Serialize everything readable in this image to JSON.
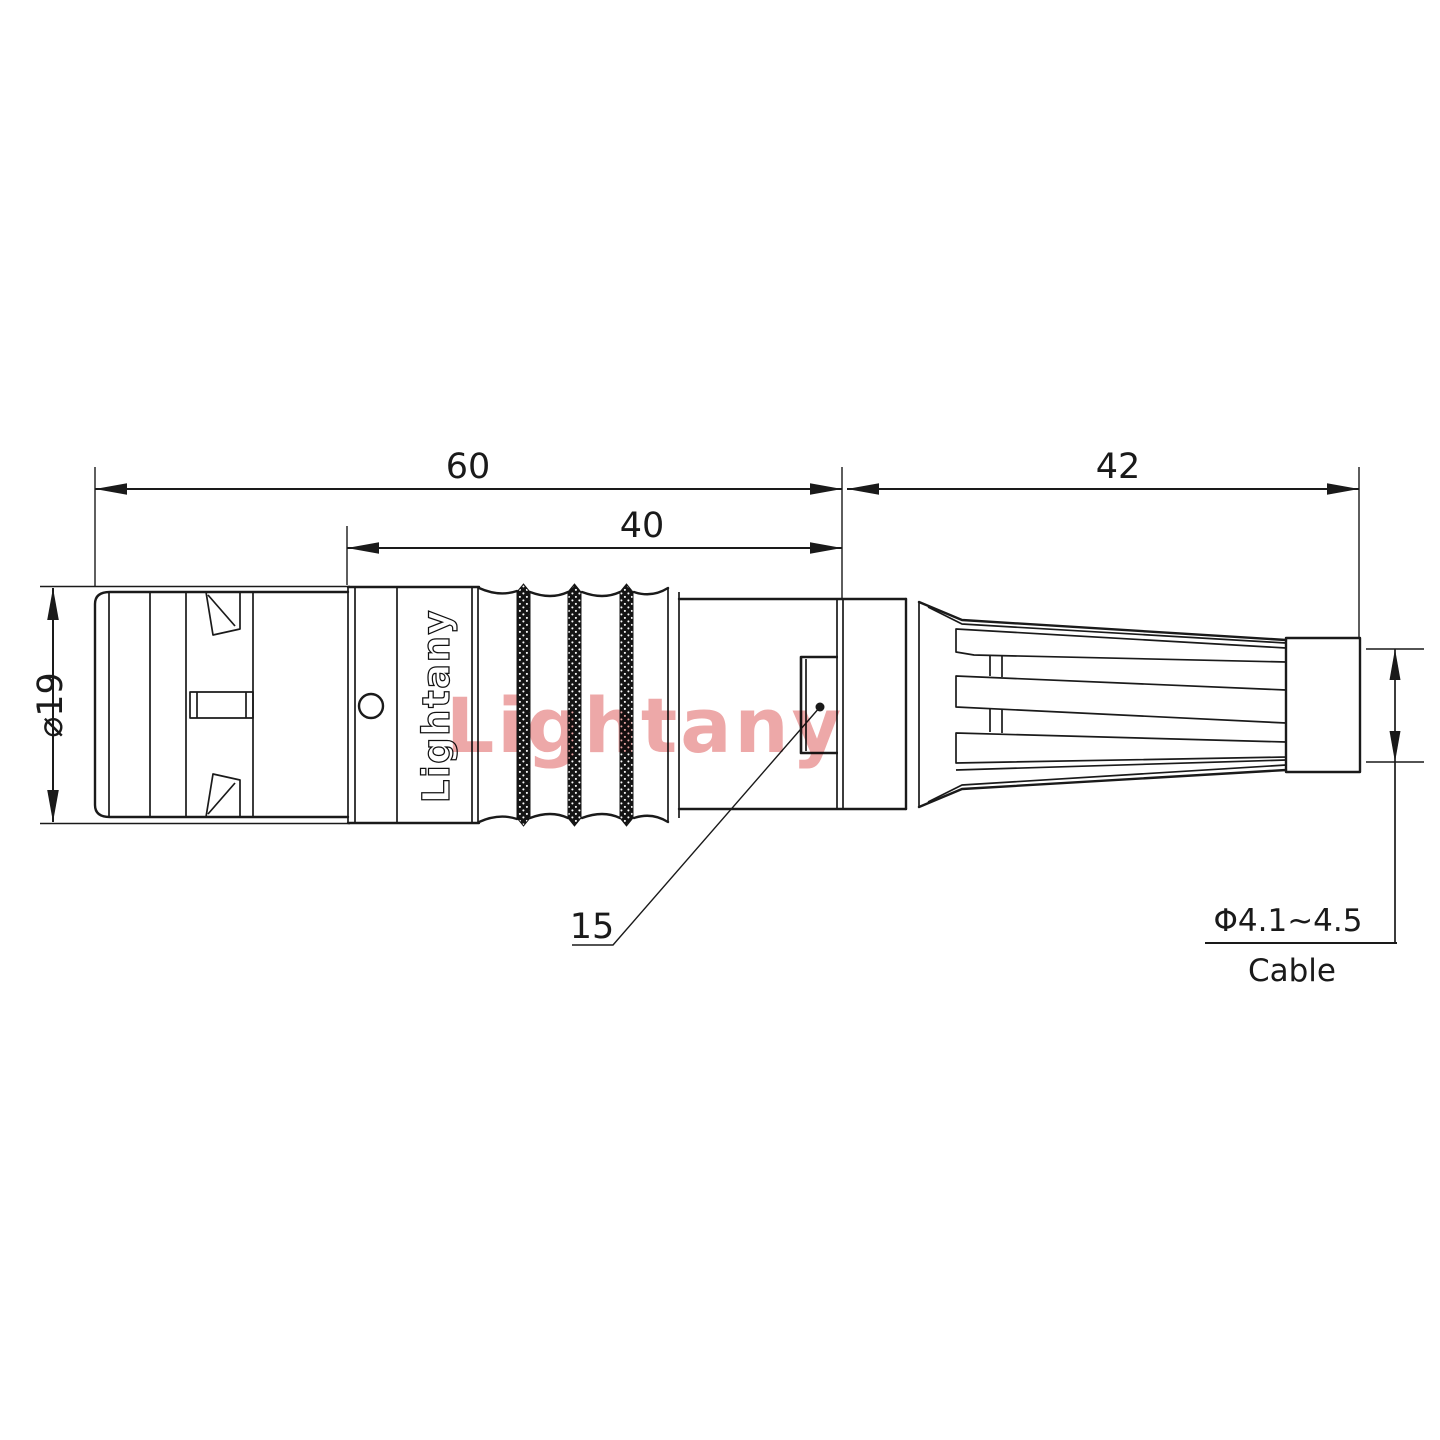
{
  "watermark": "Lightany",
  "logo": "Lightany",
  "dimensions": {
    "total_length": "60",
    "front_length": "40",
    "rear_length": "42",
    "diameter": "⌀19",
    "nut_flat": "15",
    "cable_range": "Φ4.1~4.5",
    "cable_label": "Cable"
  },
  "colors": {
    "line": "#1a1a1a",
    "watermark_pink": "#eda8a8"
  }
}
